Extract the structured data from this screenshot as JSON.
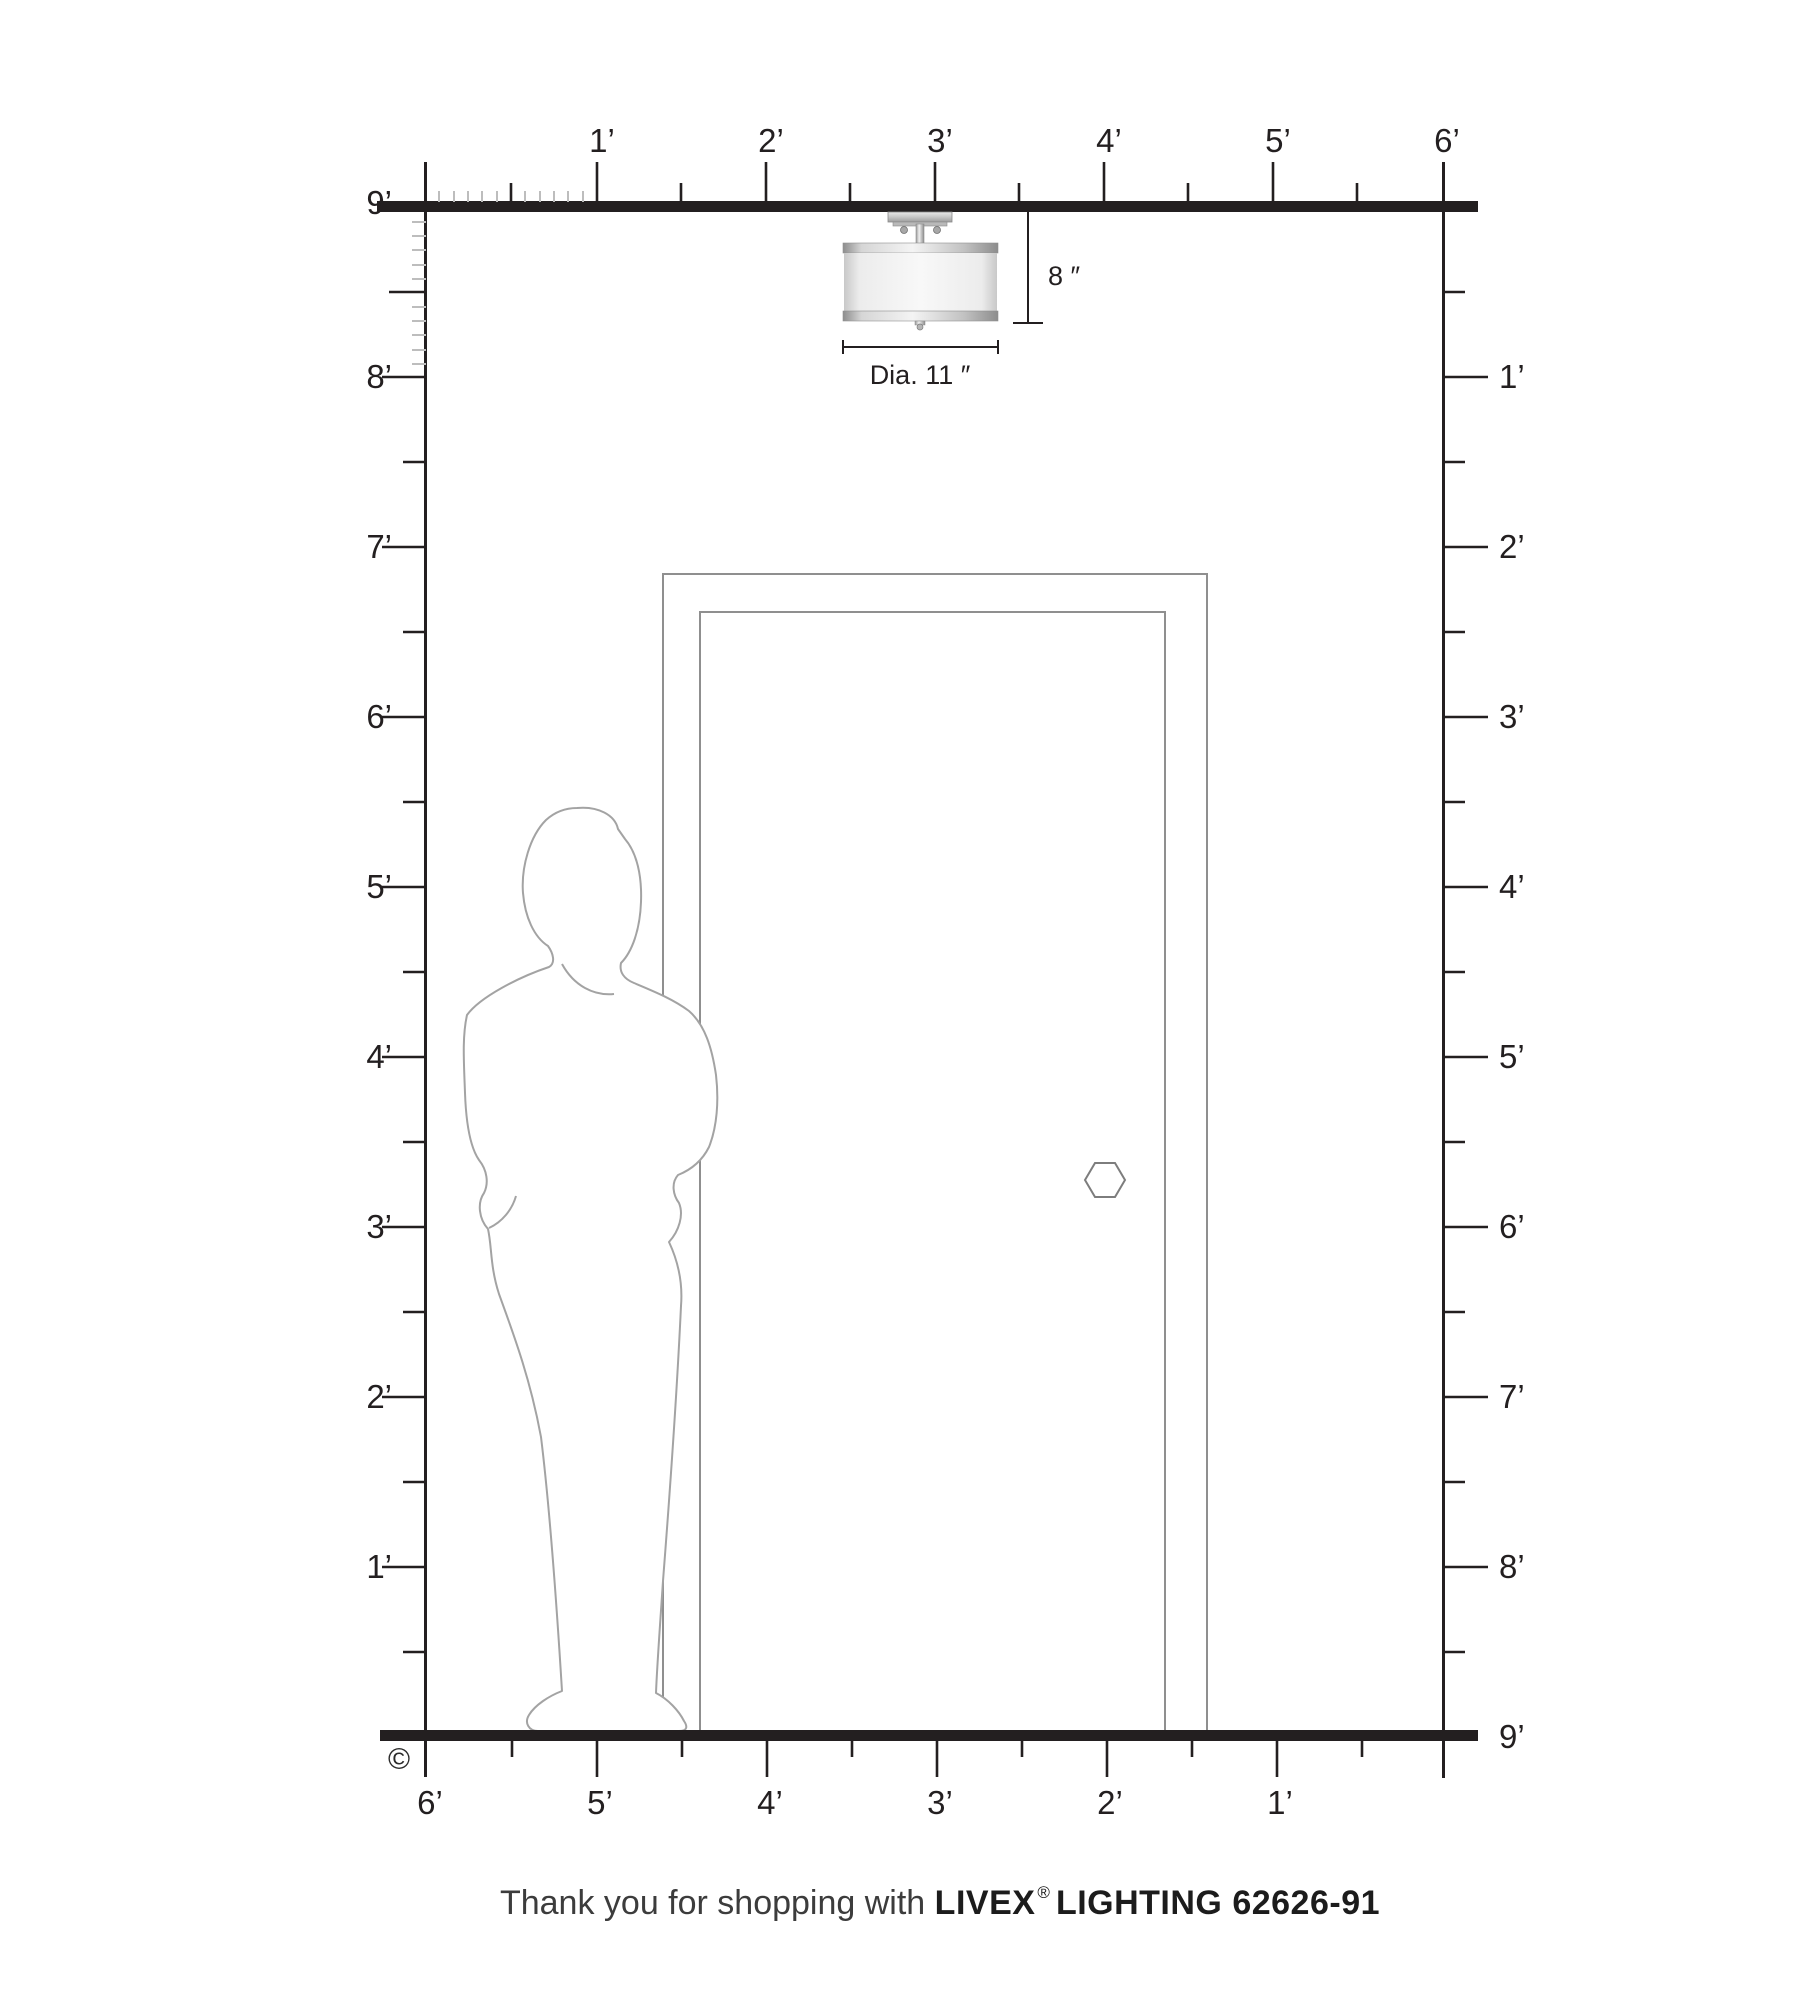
{
  "rulers": {
    "top_labels": [
      "1’",
      "2’",
      "3’",
      "4’",
      "5’",
      "6’"
    ],
    "left_labels": [
      "9’",
      "8’",
      "7’",
      "6’",
      "5’",
      "4’",
      "3’",
      "2’",
      "1’"
    ],
    "right_labels": [
      "1’",
      "2’",
      "3’",
      "4’",
      "5’",
      "6’",
      "7’",
      "8’",
      "9’"
    ],
    "bottom_labels": [
      "6’",
      "5’",
      "4’",
      "3’",
      "2’",
      "1’"
    ]
  },
  "fixture": {
    "height_label": "8 ″",
    "diameter_label": "Dia. 11 ″"
  },
  "copyright": "©",
  "footer": {
    "thanks": "Thank you for shopping with ",
    "brand": "LIVEX",
    "registered": "®",
    "product": "LIGHTING 62626-91"
  },
  "colors": {
    "line_black": "#231f20",
    "minor_tick_gray": "#bdbdbd",
    "door_gray": "#8f8f8f",
    "person_gray": "#a3a3a3"
  }
}
